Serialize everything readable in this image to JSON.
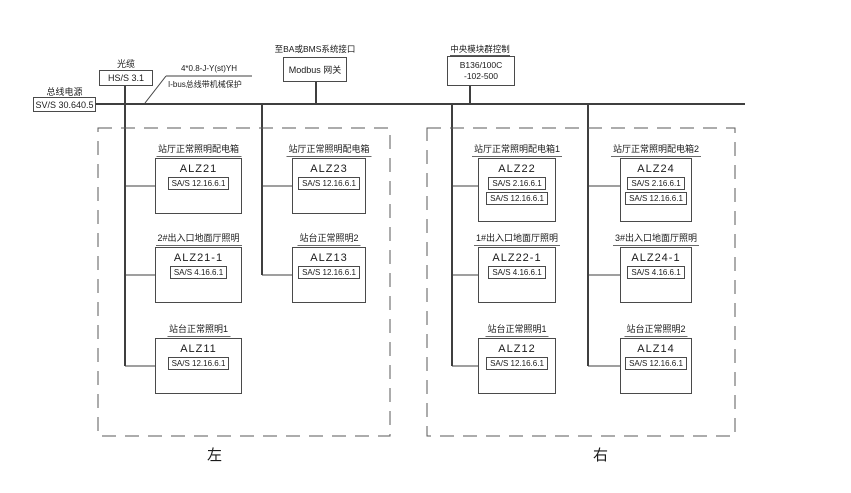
{
  "drawing": {
    "title_hint": "KNX lighting distribution riser diagram",
    "colors": {
      "background": "#ffffff",
      "line": "#4a4a4a",
      "text": "#1a1a1a"
    },
    "bus_power": {
      "label": "总线电源",
      "model": "SV/S 30.640.5"
    },
    "head_device": {
      "label": "光缆",
      "model": "HS/S 3.1"
    },
    "cable_note": {
      "line1": "4*0.8-J-Y(st)YH",
      "line2": "I-bus总线带机械保护"
    },
    "modbus": {
      "label": "至BA或BMS系统接口",
      "model": "Modbus 网关"
    },
    "central_controller": {
      "label": "中央模块群控制",
      "model_line1": "B136/100C",
      "model_line2": "-102-500"
    },
    "zone_left_label": "左",
    "zone_right_label": "右",
    "panels": [
      {
        "name": "ALZ21",
        "label": "站厅正常照明配电箱",
        "modules": [
          "SA/S 12.16.6.1"
        ],
        "col": 1,
        "row": 1
      },
      {
        "name": "ALZ21-1",
        "label": "2#出入口地面厅照明",
        "modules": [
          "SA/S 4.16.6.1"
        ],
        "col": 1,
        "row": 2
      },
      {
        "name": "ALZ11",
        "label": "站台正常照明1",
        "modules": [
          "SA/S 12.16.6.1"
        ],
        "col": 1,
        "row": 3
      },
      {
        "name": "ALZ23",
        "label": "站厅正常照明配电箱",
        "modules": [
          "SA/S 12.16.6.1"
        ],
        "col": 2,
        "row": 1
      },
      {
        "name": "ALZ13",
        "label": "站台正常照明2",
        "modules": [
          "SA/S 12.16.6.1"
        ],
        "col": 2,
        "row": 2
      },
      {
        "name": "ALZ22",
        "label": "站厅正常照明配电箱1",
        "modules": [
          "SA/S 2.16.6.1",
          "SA/S 12.16.6.1"
        ],
        "col": 3,
        "row": 1
      },
      {
        "name": "ALZ22-1",
        "label": "1#出入口地面厅照明",
        "modules": [
          "SA/S 4.16.6.1"
        ],
        "col": 3,
        "row": 2
      },
      {
        "name": "ALZ12",
        "label": "站台正常照明1",
        "modules": [
          "SA/S 12.16.6.1"
        ],
        "col": 3,
        "row": 3
      },
      {
        "name": "ALZ24",
        "label": "站厅正常照明配电箱2",
        "modules": [
          "SA/S 2.16.6.1",
          "SA/S 12.16.6.1"
        ],
        "col": 4,
        "row": 1
      },
      {
        "name": "ALZ24-1",
        "label": "3#出入口地面厅照明",
        "modules": [
          "SA/S 4.16.6.1"
        ],
        "col": 4,
        "row": 2
      },
      {
        "name": "ALZ14",
        "label": "站台正常照明2",
        "modules": [
          "SA/S 12.16.6.1"
        ],
        "col": 4,
        "row": 3
      }
    ]
  }
}
